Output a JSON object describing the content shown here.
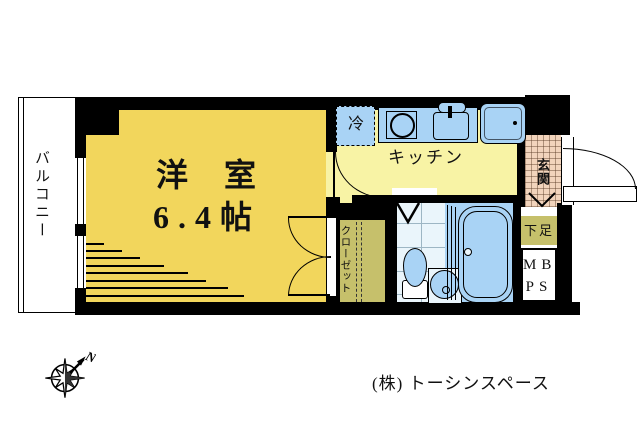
{
  "plan": {
    "balcony_label": "バルコニー",
    "room_name": "洋　室",
    "room_size": "6.4帖",
    "kitchen_label": "キッチン",
    "fridge_label": "冷",
    "closet_label": "クローゼット",
    "entrance_label": "玄関",
    "shoe_label": "下足",
    "mb_label": "MB",
    "ps_label": "PS"
  },
  "compass": {
    "north": "N"
  },
  "credit": "(株) トーシンスペース",
  "colors": {
    "wall": "#000000",
    "room_yellow": "#f2d65c",
    "kitchen_pale_yellow": "#f8f3a5",
    "fixture_blue": "#a9d3f5",
    "tile_blue_white": "#eaf5fb",
    "closet_olive": "#c6c06b",
    "entrance_tan": "#f2d4bc",
    "background": "#ffffff"
  }
}
